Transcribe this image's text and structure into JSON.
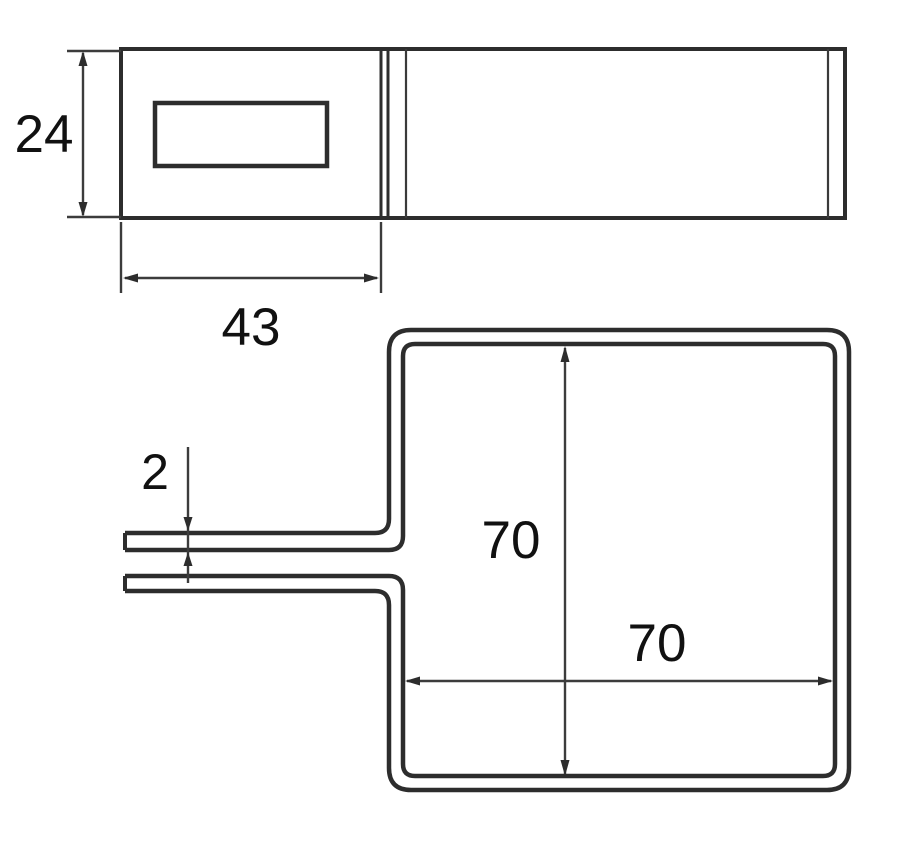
{
  "labels": {
    "top_view_height": "24",
    "top_view_flange_length": "43",
    "sheet_thickness": "2",
    "square_inner_height": "70",
    "square_inner_width": "70"
  },
  "colors": {
    "line": "#2d2d2d",
    "dimension_line": "#3c3c3c",
    "text": "#111111",
    "background": "#ffffff"
  }
}
